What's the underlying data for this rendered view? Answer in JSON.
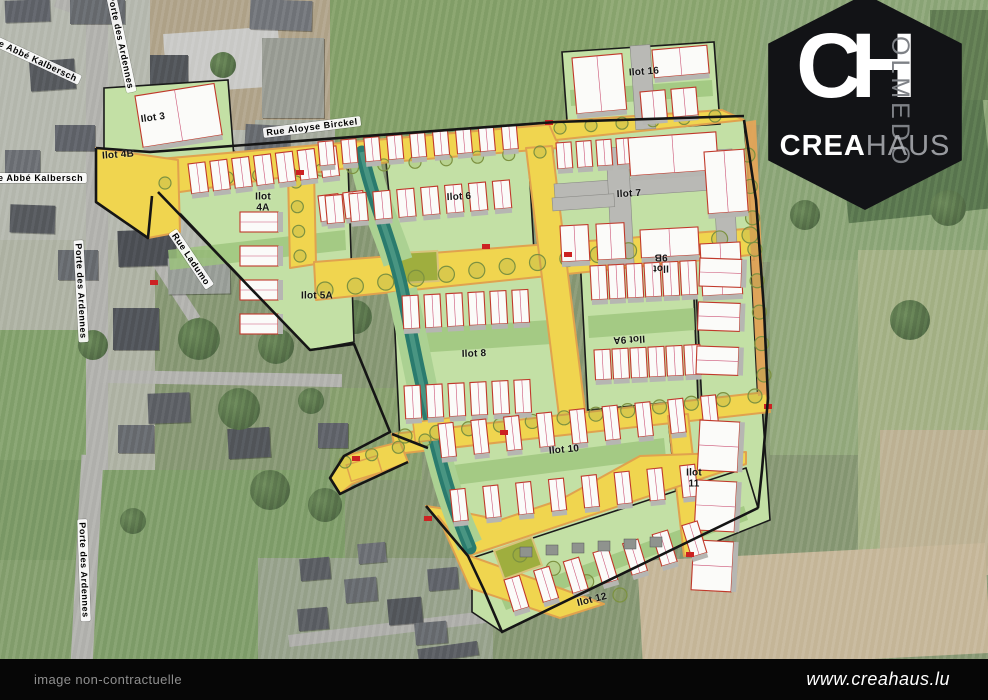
{
  "map": {
    "ilots": [
      {
        "id": "ilot-3",
        "label": "Ilot 3",
        "x": 153,
        "y": 118,
        "rot": -8
      },
      {
        "id": "ilot-4b",
        "label": "Ilot 4B",
        "x": 118,
        "y": 155,
        "rot": -4
      },
      {
        "id": "ilot-4a",
        "label": "Ilot 4A",
        "x": 263,
        "y": 203,
        "rot": 0,
        "stacked": true
      },
      {
        "id": "ilot-5a",
        "label": "Ilot 5A",
        "x": 317,
        "y": 296,
        "rot": 0
      },
      {
        "id": "ilot-6",
        "label": "Ilot 6",
        "x": 459,
        "y": 197,
        "rot": -3
      },
      {
        "id": "ilot-7",
        "label": "Ilot 7",
        "x": 629,
        "y": 194,
        "rot": -3
      },
      {
        "id": "ilot-8",
        "label": "Ilot 8",
        "x": 474,
        "y": 354,
        "rot": -2
      },
      {
        "id": "ilot-9a",
        "label": "Ilot 9A",
        "x": 629,
        "y": 339,
        "rot": 177
      },
      {
        "id": "ilot-9b",
        "label": "Ilot 9B",
        "x": 661,
        "y": 262,
        "rot": 180,
        "stacked": true
      },
      {
        "id": "ilot-10",
        "label": "Ilot 10",
        "x": 564,
        "y": 450,
        "rot": -5
      },
      {
        "id": "ilot-11",
        "label": "Ilot 11",
        "x": 694,
        "y": 479,
        "rot": 0,
        "stacked": true
      },
      {
        "id": "ilot-12",
        "label": "Ilot 12",
        "x": 592,
        "y": 600,
        "rot": -14
      },
      {
        "id": "ilot-16",
        "label": "Ilot 16",
        "x": 644,
        "y": 72,
        "rot": -4
      }
    ],
    "streets": [
      {
        "id": "rue-abbe-kalbersch-upper",
        "label": "Rue Abbé Kalbersch",
        "x": 32,
        "y": 58,
        "rot": 25
      },
      {
        "id": "porte-des-ardennes-top",
        "label": "Porte des Ardennes",
        "x": 121,
        "y": 42,
        "rot": 78
      },
      {
        "id": "rue-abbe-kalbersch-lower",
        "label": "Rue Abbé Kalbersch",
        "x": 34,
        "y": 178,
        "rot": 0
      },
      {
        "id": "porte-des-ardennes-mid",
        "label": "Porte des Ardennes",
        "x": 81,
        "y": 291,
        "rot": 87
      },
      {
        "id": "rue-ladumo",
        "label": "Rue Ladumo",
        "x": 191,
        "y": 259,
        "rot": 56
      },
      {
        "id": "porte-des-ardennes-bottom",
        "label": "Porte des Ardennes",
        "x": 84,
        "y": 570,
        "rot": 88
      },
      {
        "id": "rue-aloyse-birckel",
        "label": "Rue Aloyse Birckel",
        "x": 312,
        "y": 127,
        "rot": -7
      }
    ]
  },
  "logo": {
    "monogram": "CH",
    "vertical": "OLMEDO",
    "brand_bold": "CREA",
    "brand_light": "HAUS"
  },
  "footer": {
    "left": "image non-contractuelle",
    "right": "www.creahaus.lu"
  },
  "colors": {
    "lot_green": "#c3e0a5",
    "garden_green": "#9cc47c",
    "road_yellow": "#f0d54f",
    "road_edge_orange": "#e0a24e",
    "stream_teal": "#2a7b6e",
    "building_fill": "#fbfbf9",
    "building_outline_red": "#c0392b",
    "plan_boundary": "#151515",
    "plaza_olive": "#9fae3e",
    "logo_bg": "#121316",
    "footer_bg": "#060606"
  }
}
